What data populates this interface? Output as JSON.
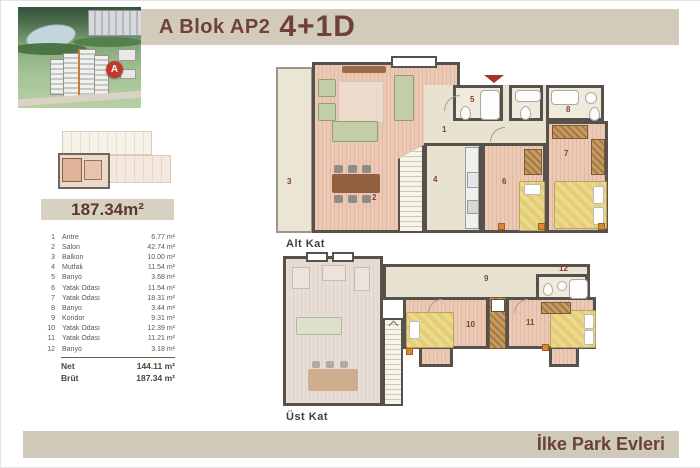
{
  "header": {
    "title_prefix": "A Blok AP2",
    "title_suffix": "4+1D",
    "building_marker": "A"
  },
  "area_badge": "187.34m²",
  "rooms": [
    {
      "no": "1",
      "name": "Antre",
      "area": "6.77 m²"
    },
    {
      "no": "2",
      "name": "Salon",
      "area": "42.74 m²"
    },
    {
      "no": "3",
      "name": "Balkon",
      "area": "10.00 m²"
    },
    {
      "no": "4",
      "name": "Mutfak",
      "area": "11.54 m²"
    },
    {
      "no": "5",
      "name": "Banyo",
      "area": "3.68 m²"
    },
    {
      "no": "6",
      "name": "Yatak Odası",
      "area": "11.54 m²"
    },
    {
      "no": "7",
      "name": "Yatak Odası",
      "area": "18.31 m²"
    },
    {
      "no": "8",
      "name": "Banyo",
      "area": "3.44 m²"
    },
    {
      "no": "9",
      "name": "Koridor",
      "area": "9.31 m²"
    },
    {
      "no": "10",
      "name": "Yatak Odası",
      "area": "12.39 m²"
    },
    {
      "no": "11",
      "name": "Yatak Odası",
      "area": "11.21 m²"
    },
    {
      "no": "12",
      "name": "Banyo",
      "area": "3.18 m²"
    }
  ],
  "totals": {
    "net_label": "Net",
    "net_value": "144.11 m²",
    "brut_label": "Brüt",
    "brut_value": "187.34 m²"
  },
  "plans": {
    "alt": {
      "label": "Alt Kat",
      "n1": "1",
      "n2": "2",
      "n3": "3",
      "n4": "4",
      "n5": "5",
      "n6": "6",
      "n7": "7",
      "n8": "8"
    },
    "ust": {
      "label": "Üst Kat",
      "n9": "9",
      "n10": "10",
      "n11": "11",
      "n12": "12"
    }
  },
  "footer": {
    "project": "İlke Park Evleri"
  },
  "colors": {
    "accent_brown": "#6e4237",
    "beige_bar": "#d2cbbc",
    "wall_gray": "#57514b",
    "wood_floor": "#e8c3ae",
    "marker_red": "#c0392b",
    "bed_yellow": "#ecd98a"
  }
}
